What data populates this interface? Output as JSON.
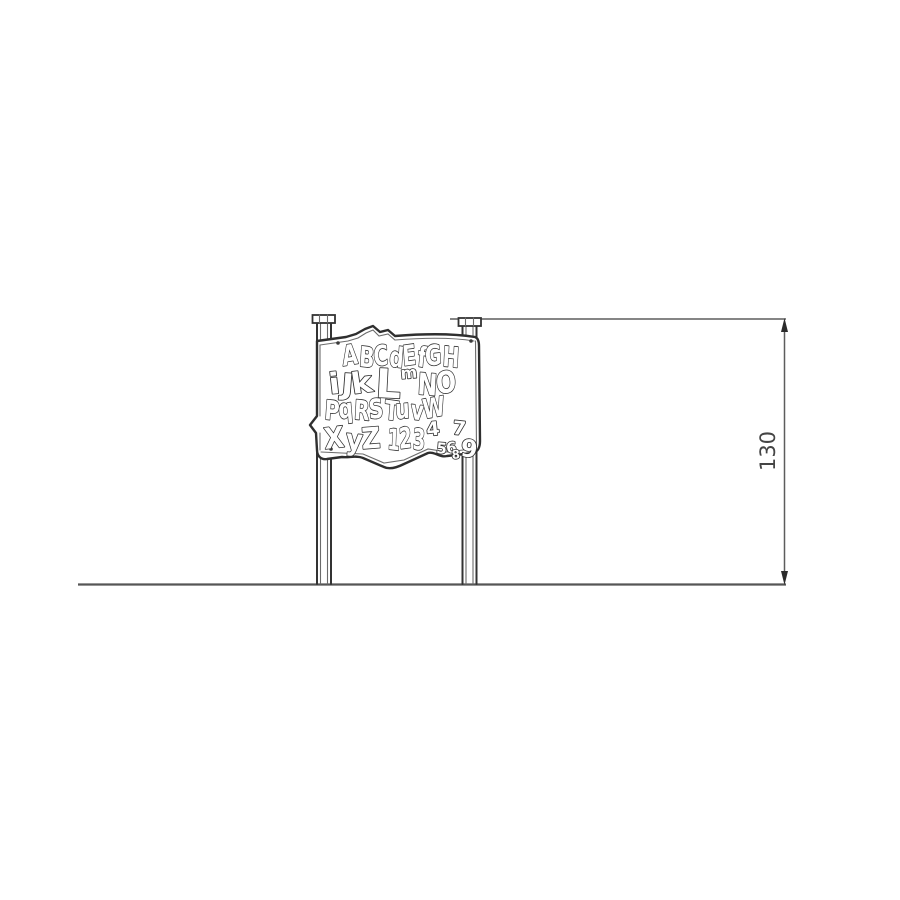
{
  "drawing": {
    "dimension": {
      "height_label": "130"
    },
    "panel": {
      "row1": "ABCdEfGH",
      "row2": {
        "ijk": "iJk",
        "l": "L",
        "m": "m",
        "no": "NO"
      },
      "row3": "PqRSTuvW",
      "row4": {
        "xyz": "XyZ",
        "n123": "123",
        "n4": "4",
        "n56": "56",
        "n7": "7",
        "n8": "8",
        "n9": "9"
      }
    },
    "colors": {
      "line": "#333333",
      "dimension": "#5d5d5d"
    }
  }
}
